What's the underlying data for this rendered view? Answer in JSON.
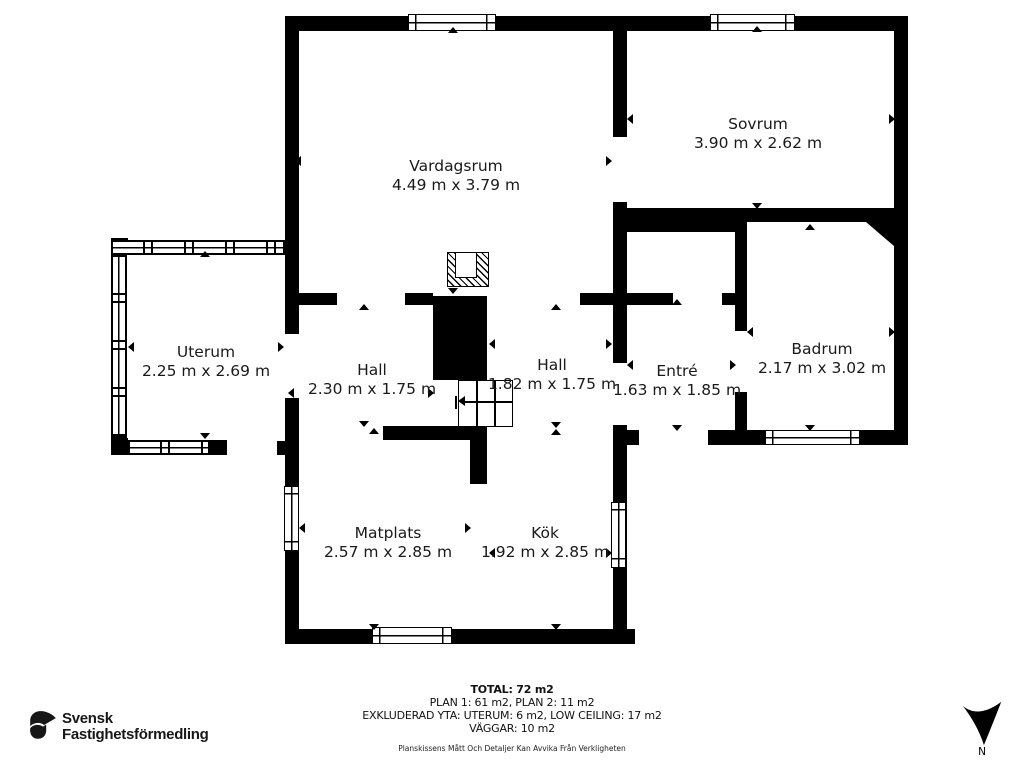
{
  "plan": {
    "rooms": [
      {
        "name": "Vardagsrum",
        "dims": "4.49 m x 3.79 m"
      },
      {
        "name": "Sovrum",
        "dims": "3.90 m x 2.62 m"
      },
      {
        "name": "Uterum",
        "dims": "2.25 m x 2.69 m"
      },
      {
        "name": "Hall",
        "dims": "2.30 m x 1.75 m"
      },
      {
        "name": "Hall",
        "dims": "1.82 m x 1.75 m"
      },
      {
        "name": "Entré",
        "dims": "1.63 m x 1.85 m"
      },
      {
        "name": "Badrum",
        "dims": "2.17 m x 3.02 m"
      },
      {
        "name": "Matplats",
        "dims": "2.57 m x 2.85 m"
      },
      {
        "name": "Kök",
        "dims": "1.92 m x 2.85 m"
      }
    ],
    "compass_label": "N"
  },
  "summary": {
    "total": "TOTAL: 72 m2",
    "plans": "PLAN 1: 61 m2, PLAN 2: 11 m2",
    "excluded": "EXKLUDERAD YTA: UTERUM: 6 m2, LOW CEILING: 17 m2",
    "walls": "VÄGGAR: 10 m2",
    "disclaimer": "Planskissens Mått Och Detaljer Kan Avvika Från Verkligheten"
  },
  "branding": {
    "name_line1": "Svensk",
    "name_line2": "Fastighetsförmedling"
  },
  "colors": {
    "wall": "#000000",
    "background": "#ffffff",
    "text": "#1a1a1a"
  }
}
